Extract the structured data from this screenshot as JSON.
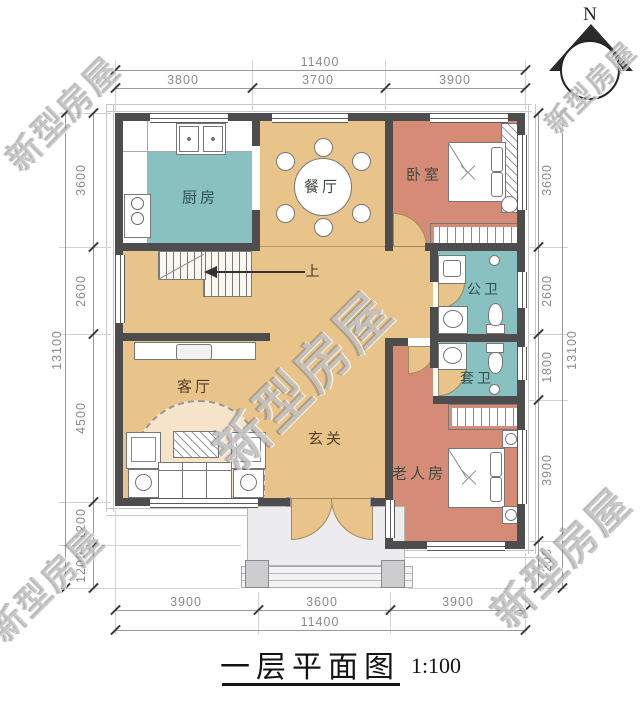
{
  "title": {
    "text": "一层平面图",
    "scale": "1:100"
  },
  "north": {
    "label": "N"
  },
  "watermark": {
    "text": "新型房屋"
  },
  "stairs": {
    "up_label": "上"
  },
  "rooms": {
    "kitchen": {
      "label": "厨房"
    },
    "dining": {
      "label": "餐厅"
    },
    "bedroom": {
      "label": "卧室"
    },
    "public_bath": {
      "label": "公卫"
    },
    "ensuite_bath": {
      "label": "套卫"
    },
    "living": {
      "label": "客厅"
    },
    "foyer": {
      "label": "玄关"
    },
    "elder_room": {
      "label": "老人房"
    }
  },
  "dimensions": {
    "top": {
      "overall": "11400",
      "segments": [
        "3800",
        "3700",
        "3900"
      ]
    },
    "bottom": {
      "overall": "11400",
      "segments": [
        "3900",
        "3600",
        "3900"
      ]
    },
    "left": {
      "overall": "13100",
      "segments": [
        "3600",
        "2600",
        "4500",
        "1200",
        "1200"
      ]
    },
    "right": {
      "overall": "13100",
      "segments": [
        "3600",
        "2600",
        "1800",
        "3900",
        "1200"
      ]
    }
  },
  "colors": {
    "wall": "#4d4d4d",
    "floor_tan": "#e9c48a",
    "floor_salmon": "#d68b76",
    "floor_teal": "#89c0c0",
    "porch_gray": "#ececee",
    "dim_text": "#8a8a8a"
  }
}
